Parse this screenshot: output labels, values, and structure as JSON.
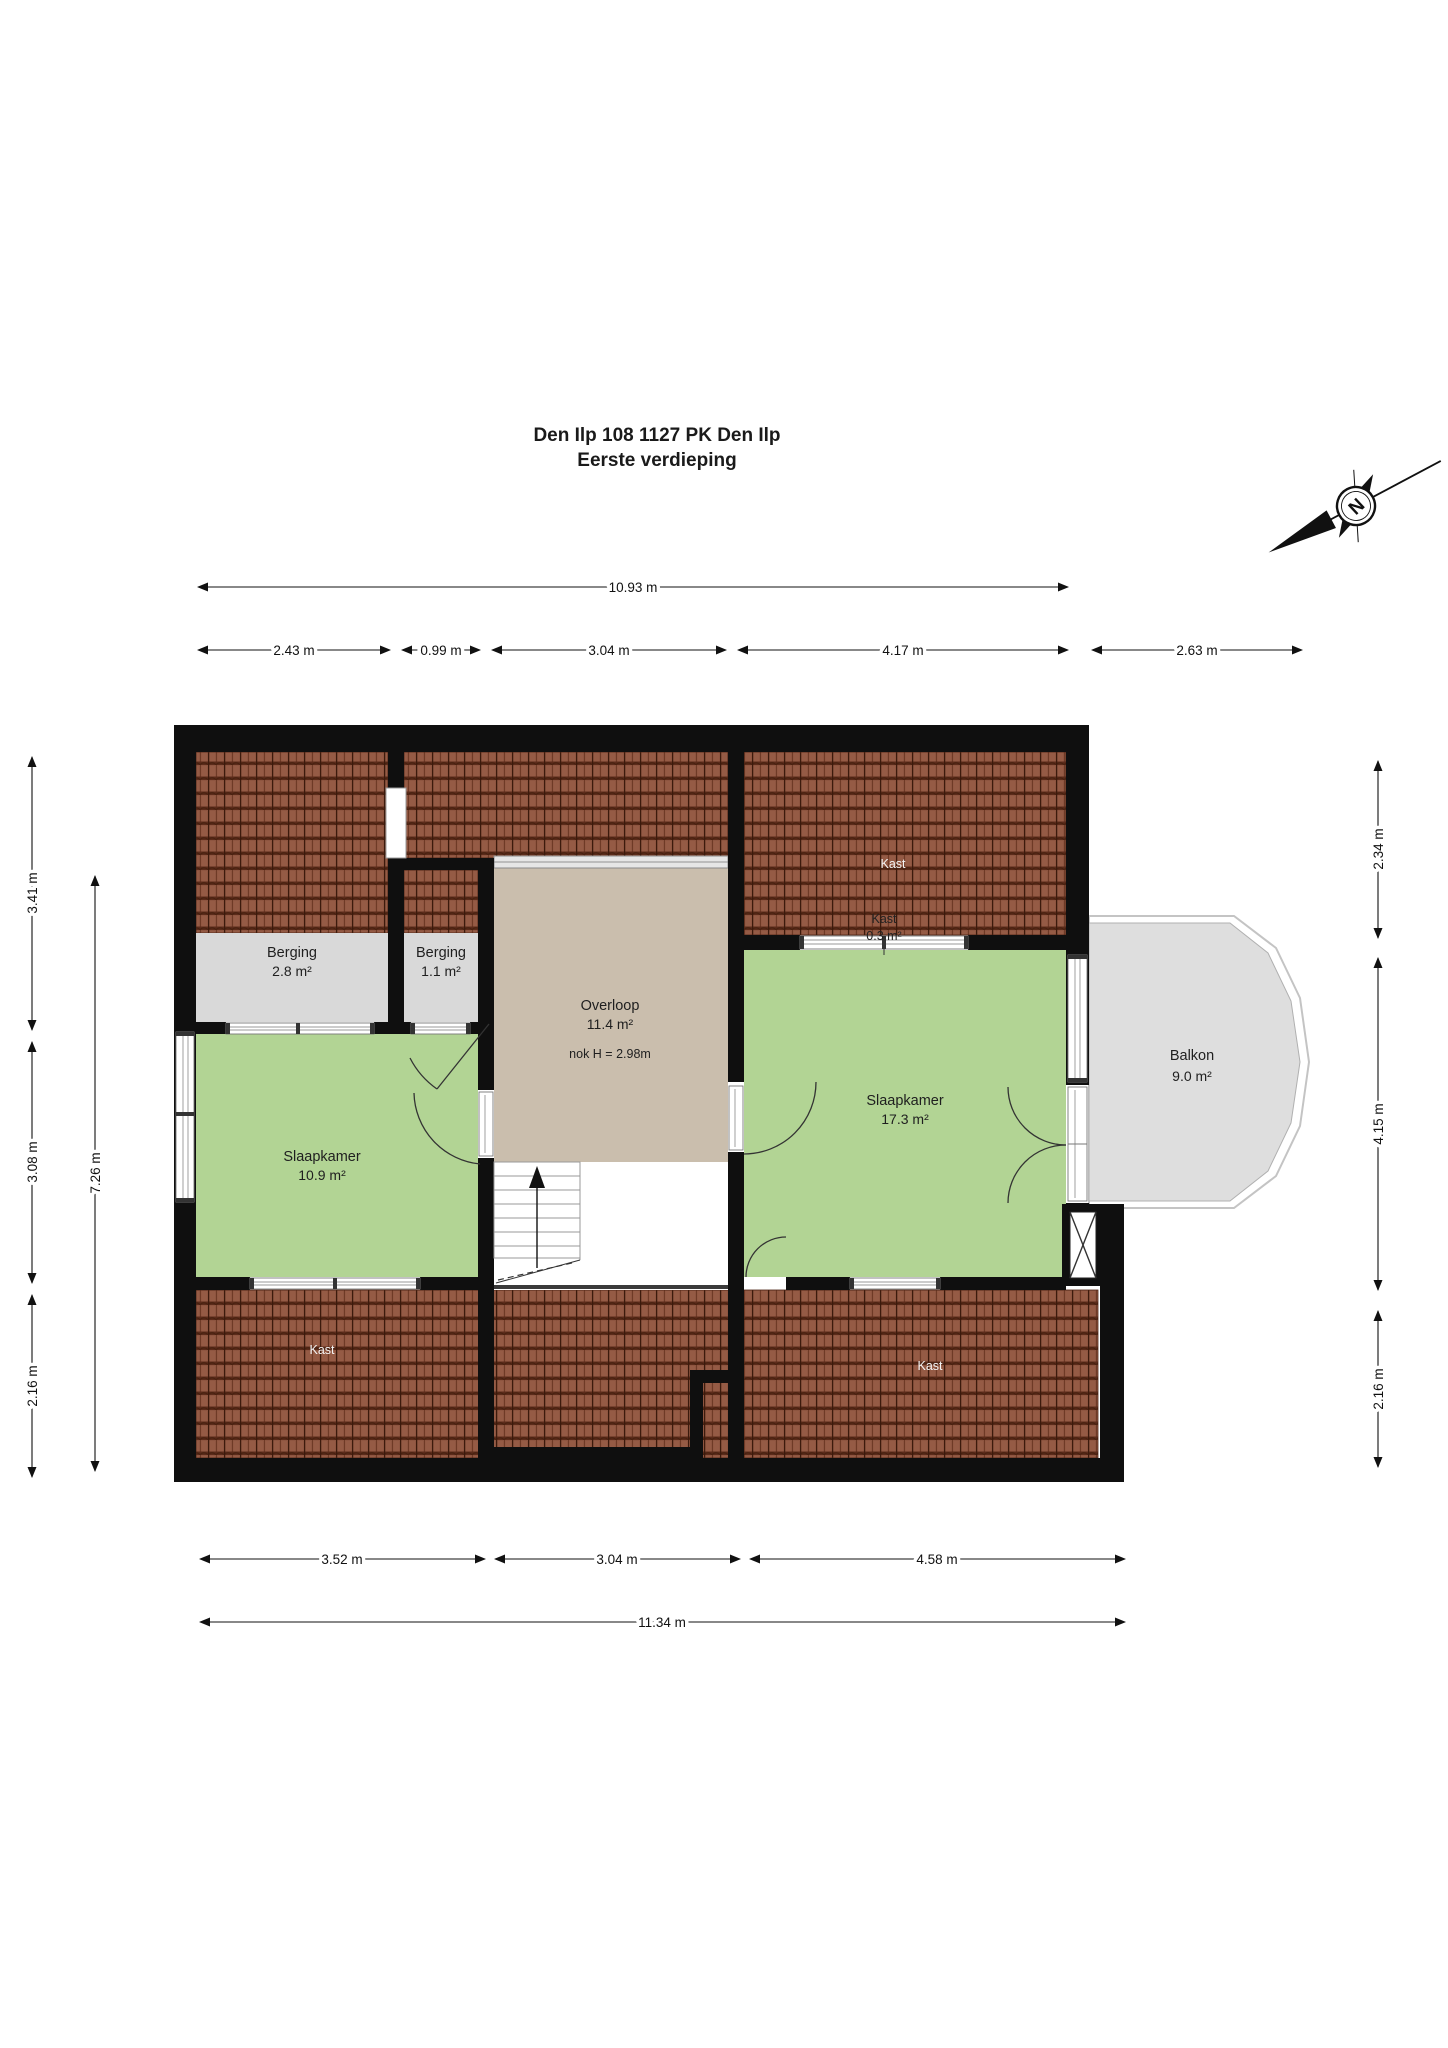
{
  "title": {
    "line1": "Den Ilp 108 1127 PK Den Ilp",
    "line2": "Eerste verdieping"
  },
  "compass": {
    "north_label": "N"
  },
  "rooms": {
    "berging_left": {
      "name": "Berging",
      "area": "2.8 m²"
    },
    "berging_right": {
      "name": "Berging",
      "area": "1.1 m²"
    },
    "overloop": {
      "name": "Overloop",
      "area": "11.4 m²",
      "ridge_note": "nok H = 2.98m"
    },
    "slaapkamer_left": {
      "name": "Slaapkamer",
      "area": "10.9 m²"
    },
    "slaapkamer_right": {
      "name": "Slaapkamer",
      "area": "17.3 m²"
    },
    "balkon": {
      "name": "Balkon",
      "area": "9.0 m²"
    },
    "kast_top": {
      "name": "Kast"
    },
    "kast_attic": {
      "name": "Kast",
      "area": "0.3 m²"
    },
    "kast_bottom_left": {
      "name": "Kast"
    },
    "kast_bottom_right": {
      "name": "Kast"
    }
  },
  "dimensions": {
    "top_total": "10.93 m",
    "top_segments": [
      "2.43 m",
      "0.99 m",
      "3.04 m",
      "4.17 m",
      "2.63 m"
    ],
    "bottom_segments": [
      "3.52 m",
      "3.04 m",
      "4.58 m"
    ],
    "bottom_total": "11.34 m",
    "left_segments": [
      "3.41 m",
      "3.08 m",
      "2.16 m"
    ],
    "left_total": "7.26 m",
    "right_segments": [
      "2.34 m",
      "4.15 m",
      "2.16 m"
    ]
  },
  "colors": {
    "wall": "#0f0f0f",
    "room_green": "#b2d494",
    "hallway_beige": "#cabead",
    "storage_grey": "#d9d9d9",
    "balcony_grey": "#dedede",
    "roof_tile": "#8e5540"
  }
}
